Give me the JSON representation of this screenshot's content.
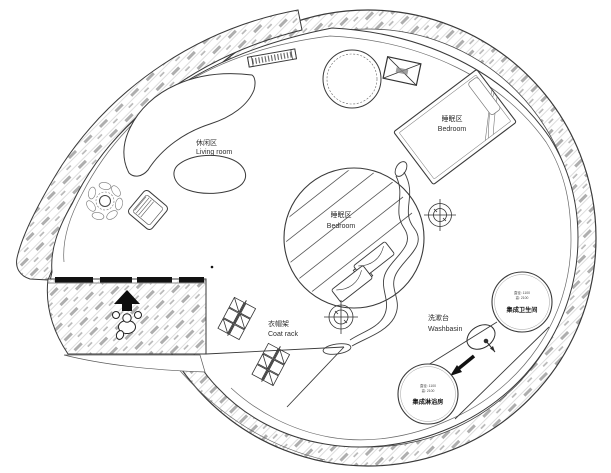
{
  "plan": {
    "areas": {
      "living": {
        "zh": "休闲区",
        "en": "Living room"
      },
      "bedroom_upper": {
        "zh": "睡眠区",
        "en": "Bedroom"
      },
      "bedroom_center": {
        "zh": "睡眠区",
        "en": "Bedroom"
      },
      "coat_rack": {
        "zh": "衣帽架",
        "en": "Coat rack"
      },
      "washbasin": {
        "zh": "洗漱台",
        "en": "Washbasin"
      },
      "bathroom_pod": {
        "name": "集成卫生间",
        "spec_line1": "直径: 1100",
        "spec_line2": "高: 2100"
      },
      "shower_pod": {
        "name": "集成淋浴房",
        "spec_line1": "直径: 1100",
        "spec_line2": "高: 2100"
      }
    },
    "colors": {
      "line": "#3a3a3a",
      "hatch_light": "#cfcfcf",
      "hatch_dash": "#adadad",
      "paper": "#ffffff"
    }
  }
}
